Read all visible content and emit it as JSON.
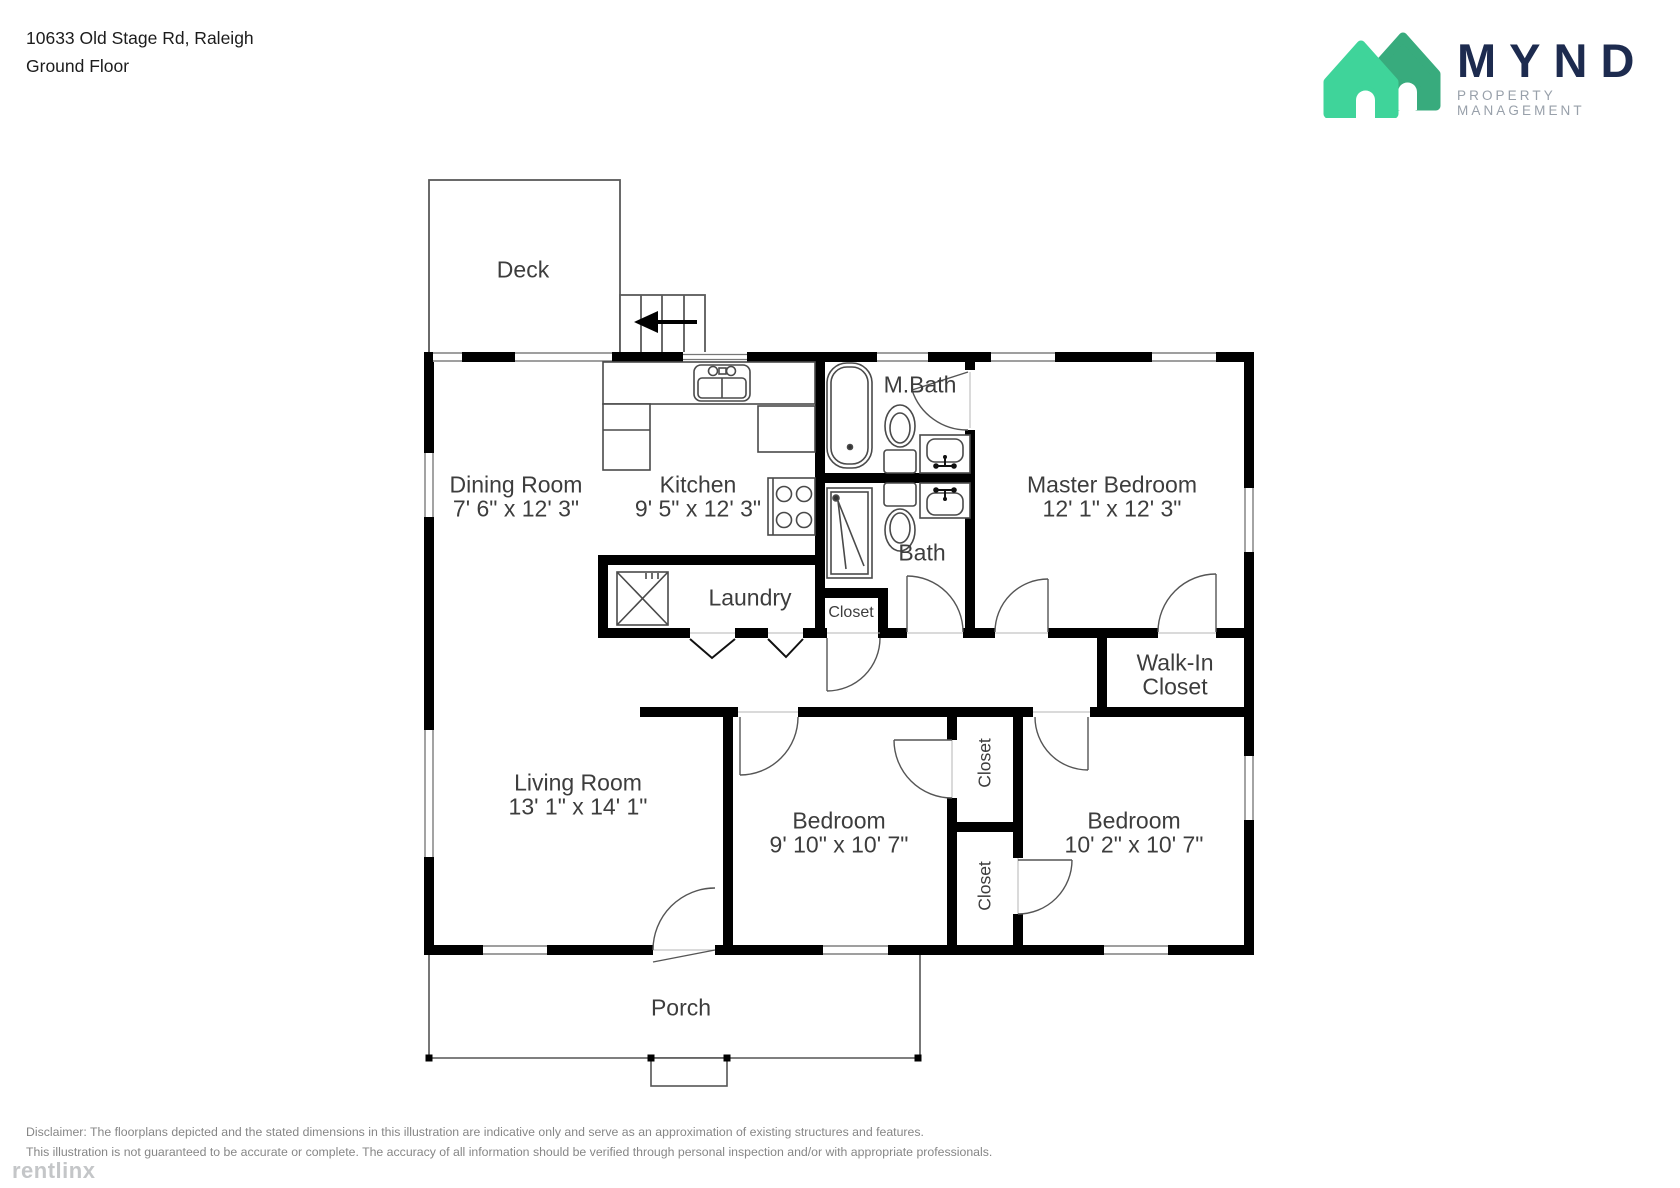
{
  "header": {
    "address_line1": "10633 Old Stage Rd, Raleigh",
    "address_line2": "Ground Floor"
  },
  "brand": {
    "name": "MYND",
    "tagline": "PROPERTY MANAGEMENT",
    "house_front_color": "#3fd49a",
    "house_back_color": "#38ab7d",
    "name_color": "#1d2b4f",
    "tagline_color": "#98a0aa"
  },
  "floorplan": {
    "wall_color": "#000000",
    "label_color": "#3d3d3d",
    "rooms": [
      {
        "id": "deck",
        "line1": "Deck"
      },
      {
        "id": "dining_room",
        "line1": "Dining Room",
        "line2": "7' 6\" x 12' 3\""
      },
      {
        "id": "kitchen",
        "line1": "Kitchen",
        "line2": "9' 5\" x 12' 3\""
      },
      {
        "id": "master_bath",
        "line1": "M.Bath"
      },
      {
        "id": "bath",
        "line1": "Bath"
      },
      {
        "id": "laundry",
        "line1": "Laundry"
      },
      {
        "id": "hall_closet",
        "line1": "Closet"
      },
      {
        "id": "walk_in_closet",
        "line1": "Walk-In",
        "line2": "Closet"
      },
      {
        "id": "master_bedroom",
        "line1": "Master Bedroom",
        "line2": "12' 1\" x 12' 3\""
      },
      {
        "id": "living_room",
        "line1": "Living Room",
        "line2": "13' 1\" x 14' 1\""
      },
      {
        "id": "bedroom_1",
        "line1": "Bedroom",
        "line2": "9' 10\" x 10' 7\""
      },
      {
        "id": "bedroom_2",
        "line1": "Bedroom",
        "line2": "10' 2\" x 10' 7\""
      },
      {
        "id": "bedroom_closet_1",
        "line1": "Closet"
      },
      {
        "id": "bedroom_closet_2",
        "line1": "Closet"
      },
      {
        "id": "porch",
        "line1": "Porch"
      }
    ]
  },
  "footer": {
    "disclaimer_line1": "Disclaimer: The floorplans depicted and the stated dimensions in this illustration are indicative only and serve as an approximation of existing structures and features.",
    "disclaimer_line2": "This illustration is not guaranteed to be accurate or complete. The accuracy of all information should be verified through personal inspection and/or with appropriate professionals.",
    "watermark": "rentlinx"
  }
}
